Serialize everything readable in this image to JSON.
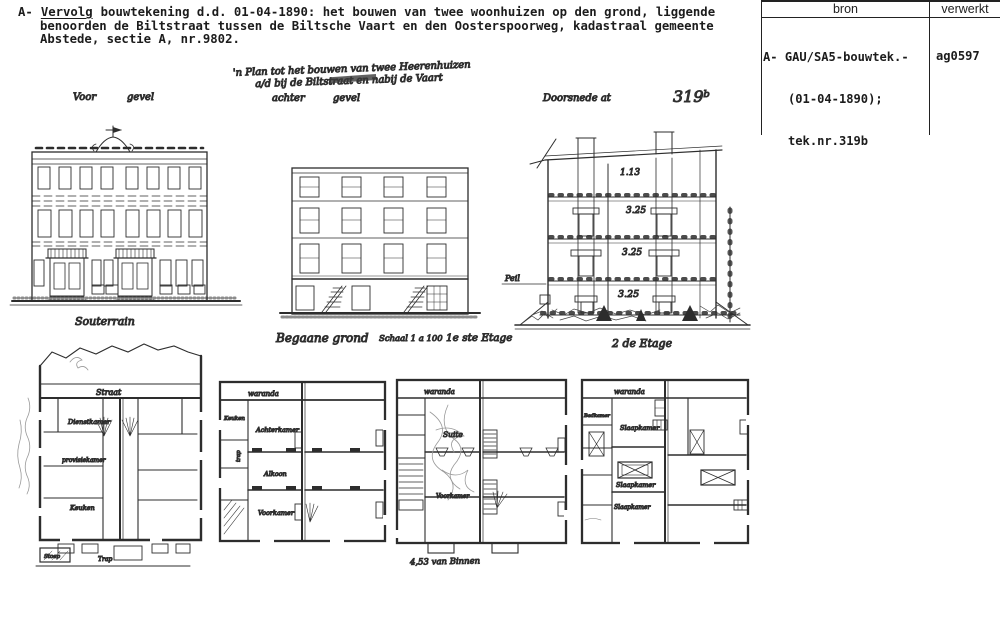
{
  "header": {
    "prefix": "A-",
    "underlined": "Vervolg",
    "line1_rest": "bouwtekening d.d. 01-04-1890: het bouwen van twee woonhuizen op den grond, liggende",
    "line2": "benoorden de Biltstraat tussen de Biltsche Vaart en den Oosterspoorweg, kadastraal gemeente",
    "line3": "Abstede, sectie A, nr.9802."
  },
  "table": {
    "col1": "bron",
    "col2": "verwerkt",
    "bron1": "A- GAU/SA5-bouwtek.-",
    "bron2": "(01-04-1890);",
    "bron3": "tek.nr.319b",
    "verwerkt": "ag0597"
  },
  "ann": {
    "pencil1": "'n Plan tot het bouwen van twee Heerenhuizen",
    "pencil2": "a/d bij de Biltstraat en nabij de Vaart",
    "voor": "Voor",
    "gevel1": "gevel",
    "achter": "achter",
    "gevel2": "gevel",
    "doorsnede": "Doorsnede at",
    "teknr": "319ᵇ",
    "souterrain": "Souterrain",
    "begane": "Begaane grond",
    "schaal": "Schaal 1 a 100",
    "etage1": "1e ste Etage",
    "etage2": "2 de Etage",
    "peil": "Peil",
    "dim1": "1.13",
    "dim2": "3.25",
    "dim3": "3.25",
    "dim4": "3.25",
    "maat": "4,53 van Binnen"
  },
  "p1": {
    "street": "Straat",
    "room1": "Dienstkamer",
    "room2": "provisiekamer",
    "room3": "Keuken",
    "stoep": "Stoep",
    "trap": "Trap"
  },
  "p2": {
    "veranda": "waranda",
    "side": "Keuken",
    "trap": "trap",
    "room1": "Achterkamer",
    "room2": "Alkoon",
    "room3": "Voorkamer"
  },
  "p3": {
    "veranda": "waranda",
    "room1": "Suite",
    "room2": "Voorkamer"
  },
  "p4": {
    "veranda": "waranda",
    "side": "Badkamer",
    "room1": "Slaapkamer",
    "room2": "Slaapkamer",
    "room3": "Slaapkamer"
  },
  "colors": {
    "ink": "#2d2d2d",
    "pencil": "#8f8f8f",
    "paper": "#ffffff"
  }
}
